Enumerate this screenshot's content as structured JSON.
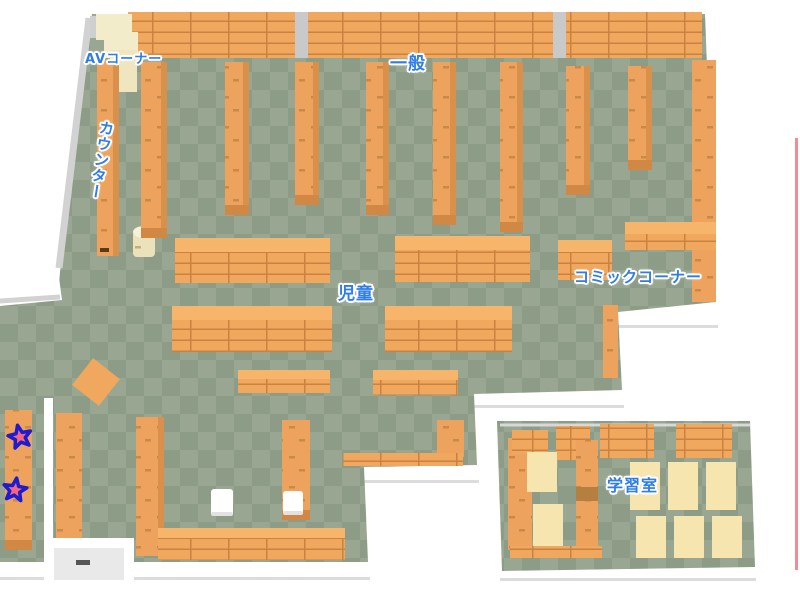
{
  "map": {
    "type": "library-floor-map",
    "areas": [
      {
        "id": "av_corner",
        "label": "AVコーナー"
      },
      {
        "id": "general",
        "label": "一般"
      },
      {
        "id": "counter",
        "label": "カウンター"
      },
      {
        "id": "children",
        "label": "児童"
      },
      {
        "id": "comic_corner",
        "label": "コミックコーナー"
      },
      {
        "id": "study_room",
        "label": "学習室"
      }
    ],
    "markers": {
      "star_count": 2
    },
    "palette": {
      "label_text": "#2e7de9",
      "label_outline": "#ffffff",
      "floor_light": "#99a792",
      "floor_dark": "#8d9c87",
      "shelf_top": "#f6b56a",
      "shelf_front": "#f0a75e",
      "shelf_line": "#c9823f",
      "shelf_side": "#d9904a",
      "shelf_base": "#d18845",
      "wall": "#ffffff",
      "wall_gray": "#d2d2d2",
      "table_cream": "#f6e5ae",
      "mat_cream": "#f3ecca",
      "basket_cream": "#ebe1ba",
      "star_fill": "#f4657e",
      "star_outline": "#1d1dcf",
      "edge_line": "#f48a96"
    }
  }
}
